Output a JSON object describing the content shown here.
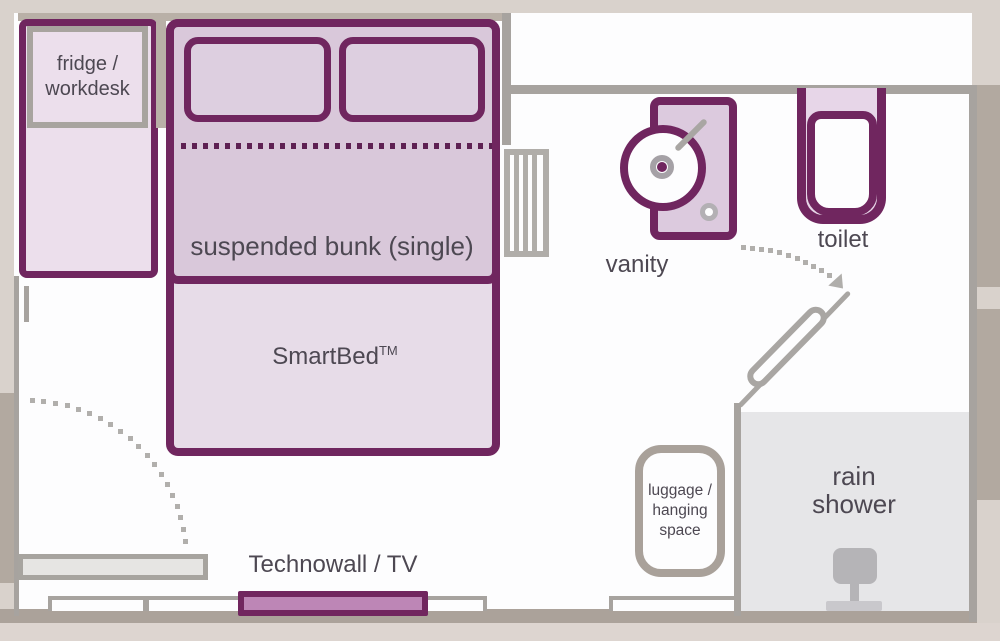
{
  "title": "cabin floor plan",
  "labels": {
    "fridge_line1": "fridge /",
    "fridge_line2": "workdesk",
    "bunk": "suspended bunk (single)",
    "smartbed": "SmartBed",
    "smartbed_sup": "TM",
    "technowall": "Technowall / TV",
    "vanity": "vanity",
    "toilet": "toilet",
    "shower_line1": "rain",
    "shower_line2": "shower",
    "luggage_line1": "luggage /",
    "luggage_line2": "hanging",
    "luggage_line3": "space"
  },
  "colors": {
    "accent_purple": "#70265f",
    "dot_purple": "#5e2153",
    "fill_bunk": "#d9c8da",
    "fill_smartbed": "#e7dce8",
    "fill_fridge": "#ecdfec",
    "fill_pillow": "#ddcfe0",
    "fill_vanity": "#dccade",
    "fill_toilet_tank": "#e7d6e8",
    "fill_tv_mauve": "#bd86b6",
    "wall_gray": "#a7a39f",
    "wall_taupe": "#b2a9a0",
    "bg_beige": "#d9d2cc",
    "shower_gray": "#e6e6e8",
    "text_gray": "#4d4852"
  }
}
